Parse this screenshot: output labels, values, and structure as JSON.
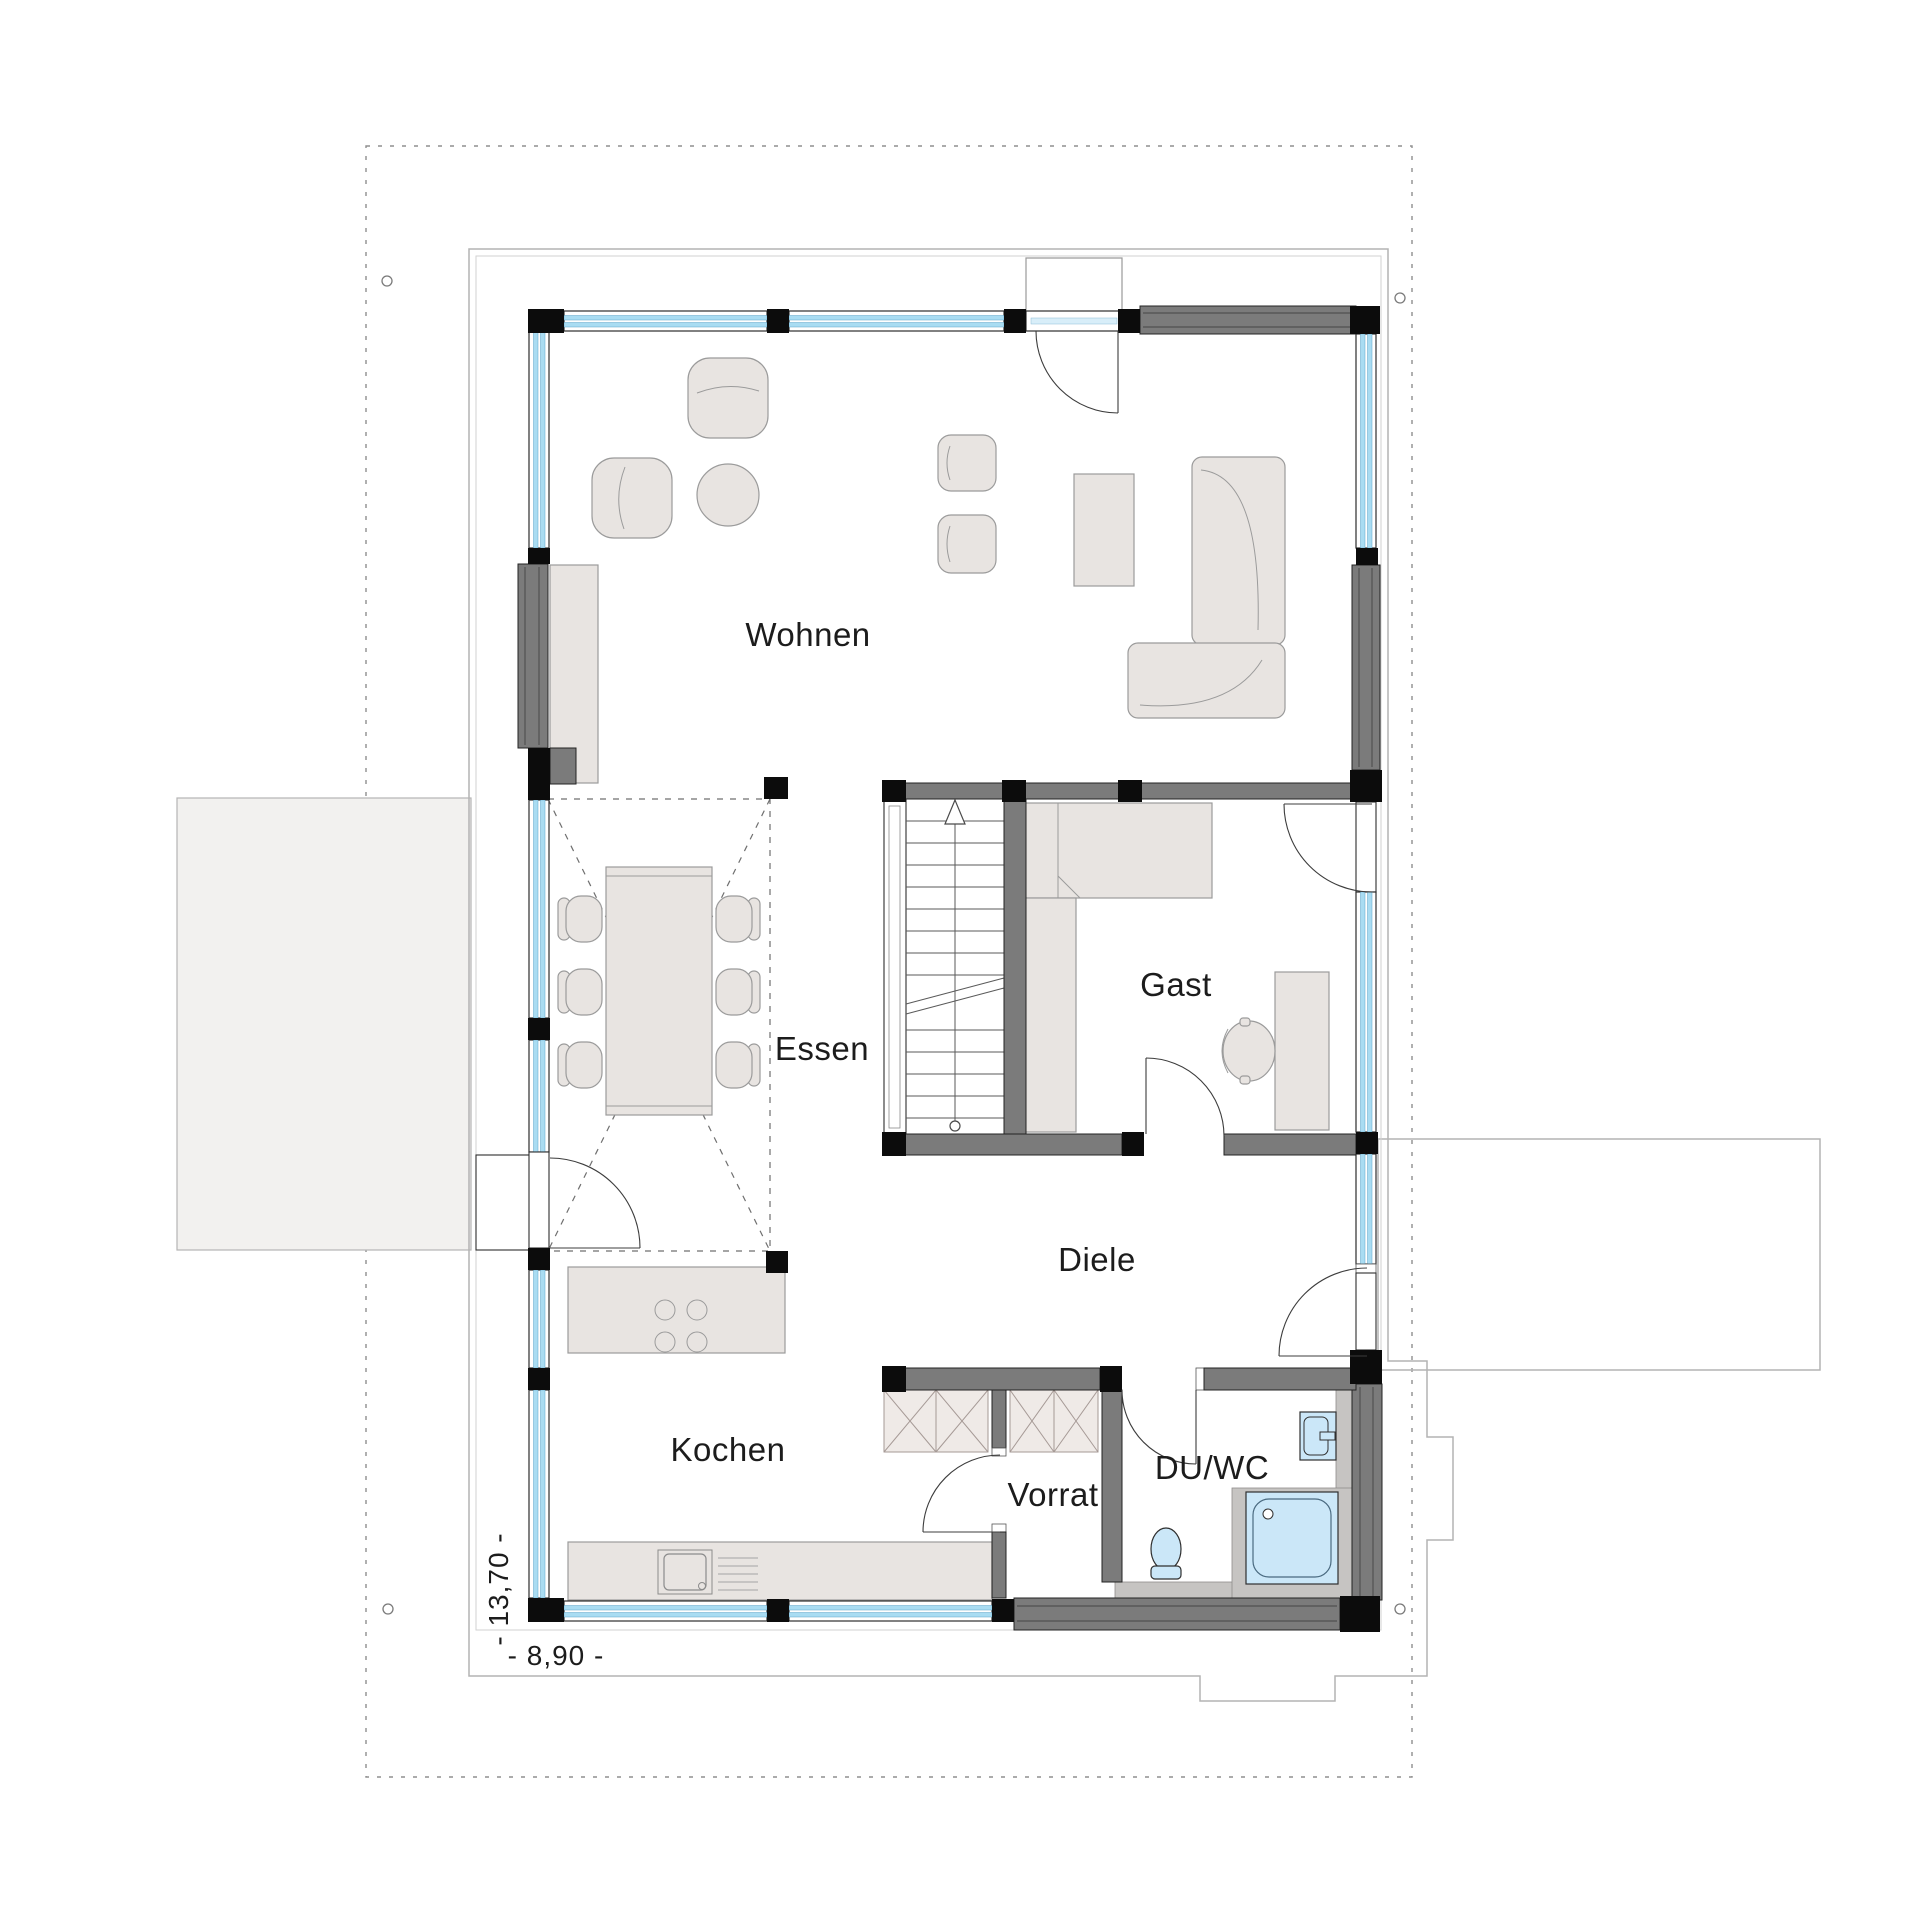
{
  "plan": {
    "type": "floorplan",
    "rooms": [
      {
        "id": "wohnen",
        "label": "Wohnen"
      },
      {
        "id": "essen",
        "label": "Essen"
      },
      {
        "id": "gast",
        "label": "Gast"
      },
      {
        "id": "diele",
        "label": "Diele"
      },
      {
        "id": "kochen",
        "label": "Kochen"
      },
      {
        "id": "vorrat",
        "label": "Vorrat"
      },
      {
        "id": "duwc",
        "label": "DU/WC"
      }
    ],
    "dimensions": {
      "vertical_label": "- 13,70 -",
      "horizontal_label": "- 8,90 -"
    }
  },
  "colors": {
    "glass": "#a9dcf2",
    "glass-edge": "#5fa3c8",
    "wall-dark": "#7b7b7b",
    "furniture": "#e8e4e1",
    "fixture": "#cbe7f8",
    "shelf": "#efeae7",
    "gray-strip": "#c6c4c2",
    "outline": "#b3b3b3",
    "dash": "#8f8f8f",
    "carport": "#f2f1ef",
    "ink": "#1c1c1c"
  }
}
